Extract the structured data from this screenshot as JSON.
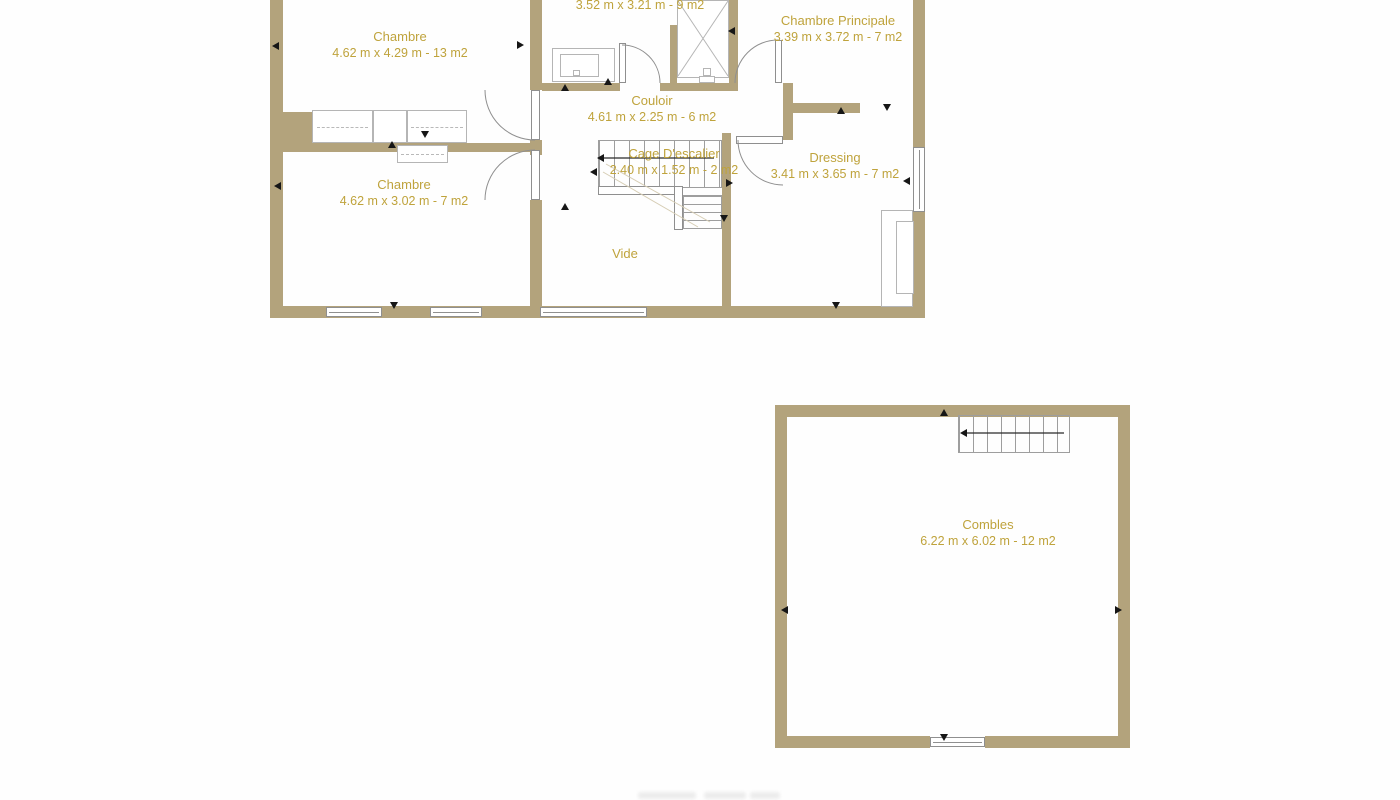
{
  "colors": {
    "wall": "#b3a37c",
    "label": "#bfa33c"
  },
  "plans": {
    "etage": {
      "rooms": [
        {
          "id": "salle-deau",
          "name": "",
          "dims": "3.52 m x 3.21 m - 9 m2"
        },
        {
          "id": "chambre-1",
          "name": "Chambre",
          "dims": "4.62 m x 4.29 m - 13 m2"
        },
        {
          "id": "chambre-principale",
          "name": "Chambre Principale",
          "dims": "3.39 m x 3.72 m - 7 m2"
        },
        {
          "id": "couloir",
          "name": "Couloir",
          "dims": "4.61 m x 2.25 m - 6 m2"
        },
        {
          "id": "cage-escalier",
          "name": "Cage D'escalier",
          "dims": "2.40 m x 1.52 m - 2 m2"
        },
        {
          "id": "dressing",
          "name": "Dressing",
          "dims": "3.41 m x 3.65 m - 7 m2"
        },
        {
          "id": "chambre-2",
          "name": "Chambre",
          "dims": "4.62 m x 3.02 m - 7 m2"
        },
        {
          "id": "vide",
          "name": "Vide",
          "dims": ""
        }
      ]
    },
    "combles": {
      "rooms": [
        {
          "id": "combles",
          "name": "Combles",
          "dims": "6.22 m x 6.02 m - 12 m2"
        }
      ]
    }
  }
}
